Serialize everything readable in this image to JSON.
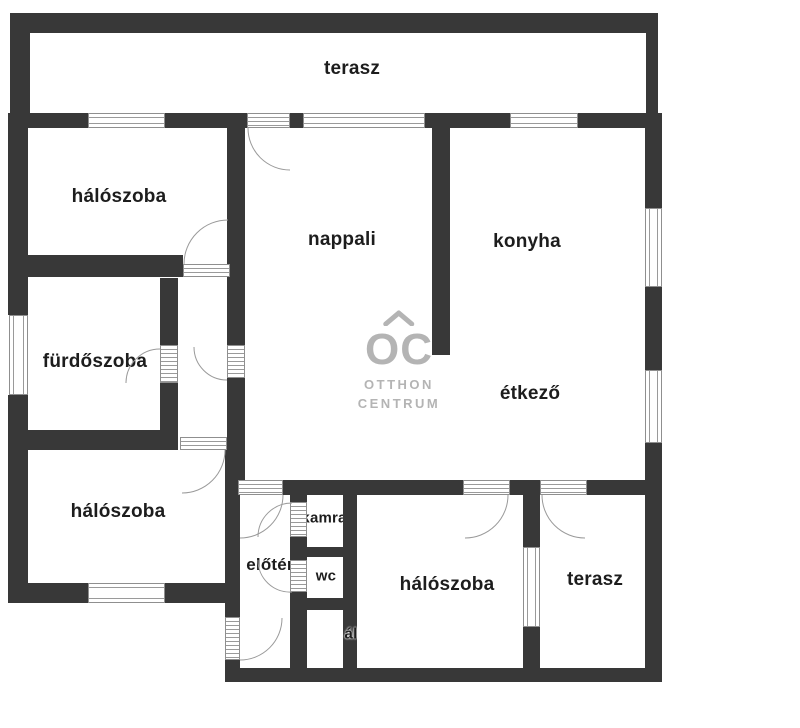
{
  "colors": {
    "wall": "#383838",
    "door_window_frame": "#9a9a9a",
    "label_text": "#1d1d1d",
    "watermark": "#b4b4b4"
  },
  "rooms": {
    "terasz_top": "terasz",
    "haloszoba_top": "hálószoba",
    "nappali": "nappali",
    "konyha": "konyha",
    "furdoszoba": "fürdőszoba",
    "etkezo": "étkező",
    "haloszoba_left": "hálószoba",
    "kamra": "kamra",
    "eloter": "előtér",
    "wc": "wc",
    "haloszoba_bottom": "hálószoba",
    "terasz_bottom": "terasz",
    "clipped_label": "ál"
  },
  "watermark": {
    "logo": "OC",
    "line1": "OTTHON",
    "line2": "CENTRUM"
  }
}
